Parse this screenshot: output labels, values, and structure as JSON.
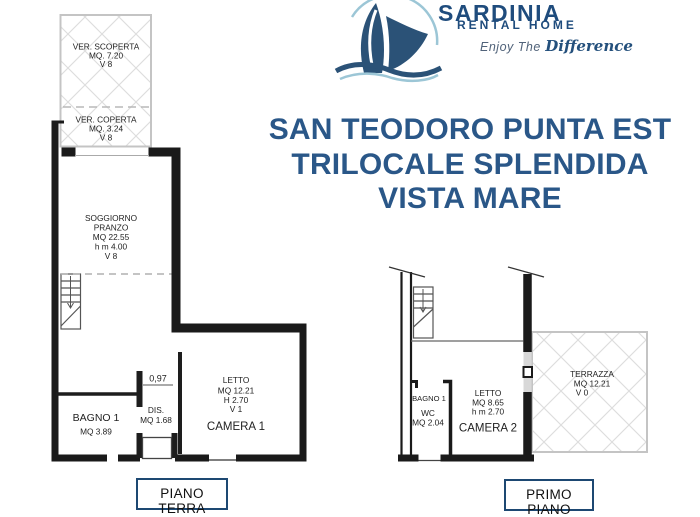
{
  "colors": {
    "wall": "#1a1a1a",
    "navy_brand": "#1f4c7d",
    "title_blue": "#2a5788",
    "hatch_gray": "#dcdcdc",
    "light_blue": "#9cc6d6"
  },
  "logo": {
    "brand": "SARDINIA",
    "sub": "RENTAL HOME",
    "tagline_pre": "Enjoy The",
    "tagline_script": "Difference"
  },
  "title": {
    "line1": "SAN TEODORO PUNTA EST",
    "line2": "TRILOCALE SPLENDIDA",
    "line3": "VISTA MARE"
  },
  "plans": {
    "ground": {
      "label": "PIANO TERRA",
      "ver_scoperta": {
        "l1": "VER. SCOPERTA",
        "l2": "MQ. 7.20",
        "l3": "V 8"
      },
      "ver_coperta": {
        "l1": "VER. COPERTA",
        "l2": "MQ. 3.24",
        "l3": "V 8"
      },
      "soggiorno": {
        "l1": "SOGGIORNO",
        "l2": "PRANZO",
        "l3": "MQ 22.55",
        "l4": "h m 4.00",
        "l5": "V 8"
      },
      "dim": "0,97",
      "bagno": {
        "l1": "BAGNO 1",
        "l2": "MQ 3.89"
      },
      "dis": {
        "l1": "DIS.",
        "l2": "MQ 1.68"
      },
      "camera": {
        "l1": "LETTO",
        "l2": "MQ 12.21",
        "l3": "H 2.70",
        "l4": "V 1",
        "l5": "CAMERA 1"
      }
    },
    "first": {
      "label": "PRIMO PIANO",
      "bagno": {
        "l1": "BAGNO 1",
        "l2": "WC",
        "l3": "MQ 2.04"
      },
      "camera": {
        "l1": "LETTO",
        "l2": "MQ 8.65",
        "l3": "h m 2.70",
        "l4": "CAMERA 2"
      },
      "terrazza": {
        "l1": "TERRAZZA",
        "l2": "MQ 12.21",
        "l3": "V 0"
      }
    }
  }
}
